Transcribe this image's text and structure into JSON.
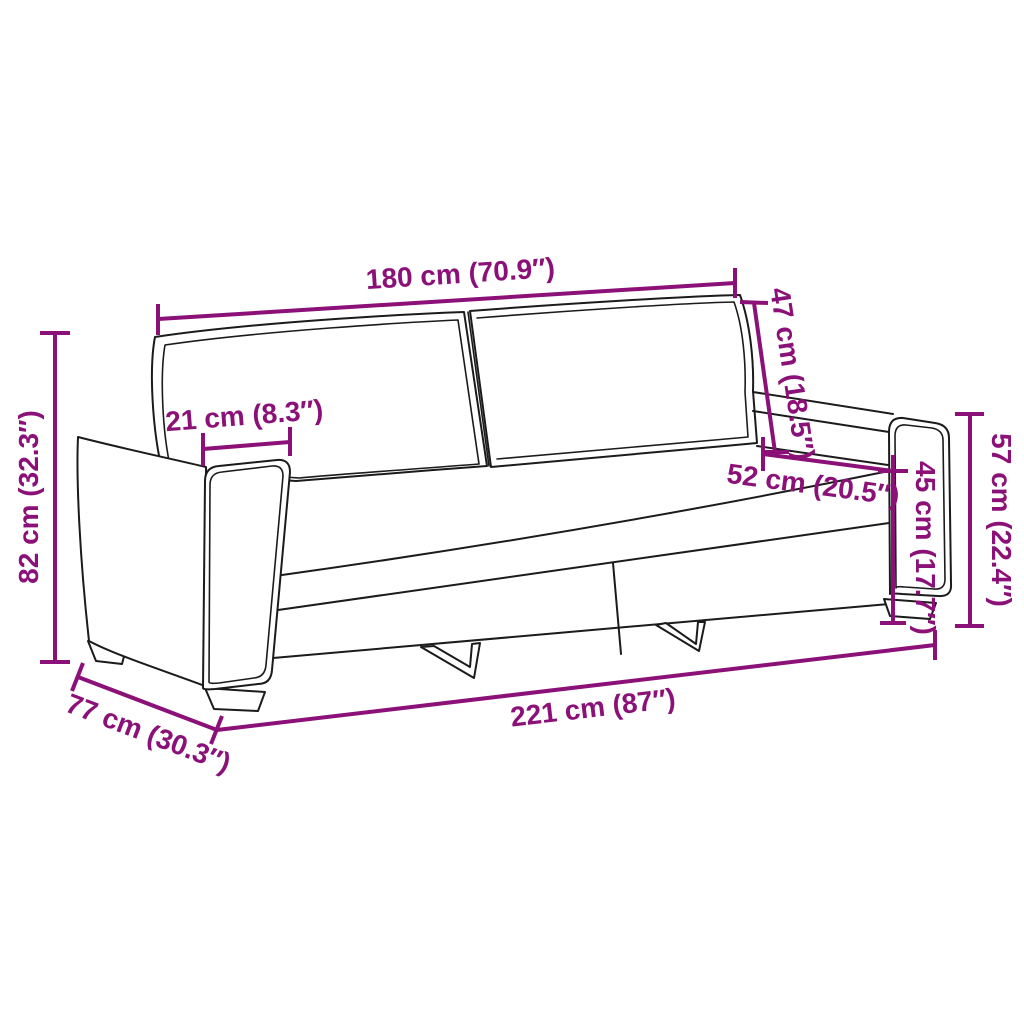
{
  "diagram": {
    "type": "product-dimension-diagram",
    "subject": "3-seater sofa line drawing with measurement annotations",
    "units": [
      "cm",
      "inches"
    ]
  },
  "colors": {
    "dimension": "#8B1078",
    "outline": "#1b1b1b",
    "background": "#ffffff"
  },
  "dimensions": {
    "back_width": {
      "label": "180 cm (70.9″)"
    },
    "backrest_height": {
      "label": "47 cm (18.5″)"
    },
    "armrest_width": {
      "label": "21 cm (8.3″)"
    },
    "total_height": {
      "label": "82 cm (32.3″)"
    },
    "seat_depth": {
      "label": "52 cm (20.5″)"
    },
    "seat_height": {
      "label": "45 cm (17.7″)"
    },
    "armrest_height": {
      "label": "57 cm (22.4″)"
    },
    "total_depth": {
      "label": "77 cm (30.3″)"
    },
    "total_width": {
      "label": "221 cm (87″)"
    }
  }
}
